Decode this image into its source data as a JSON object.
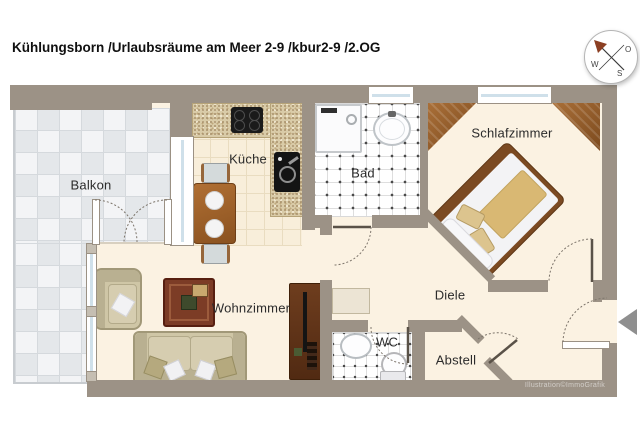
{
  "title": "Kühlungsborn /Urlaubsräume am Meer 2-9 /kbur2-9 /2.OG",
  "watermark": "Illustration©ImmoGrafik",
  "compass": {
    "east": "O",
    "south": "S",
    "west": "W"
  },
  "rooms": {
    "balcony": {
      "label": "Balkon"
    },
    "kitchen": {
      "label": "Küche"
    },
    "bath": {
      "label": "Bad"
    },
    "bedroom": {
      "label": "Schlafzimmer"
    },
    "living_room": {
      "label": "Wohnzimmer"
    },
    "hallway": {
      "label": "Diele"
    },
    "wc": {
      "label": "WC"
    },
    "storage": {
      "label": "Abstell"
    }
  },
  "colors": {
    "wall": "#9c9286",
    "floor": "#fbf2e2",
    "kitchen_floor": "#f8eeda",
    "kitchen_grid": "#e9dcc0",
    "counter": "#d9cba8",
    "counter_dot": "#a8906a",
    "tile_white": "#ffffff",
    "tile_line": "#dedede",
    "tile_dot": "#4a4a4a",
    "balcony_a": "#f3f4f6",
    "balcony_b": "#e4e7ea",
    "balcony_line": "#d5d9dd",
    "sofa": "#cfc6a6",
    "sofa_dark": "#b9b091",
    "sofa_border": "#a19878",
    "table_bg": "#7c3c26",
    "table_border": "#571f10",
    "unit_bg": "#6e3d1e",
    "unit_dark": "#3f2009",
    "bed_frame": "#7b4a22",
    "bed_blanket": "#d9b873",
    "bed_pillow": "#dcc48e",
    "arrow": "#8f8f8f",
    "arc": "#7d756b",
    "leaf": "#5a5248",
    "text": "#2b2b2b",
    "watermark": "rgba(255,255,255,0.55)"
  }
}
